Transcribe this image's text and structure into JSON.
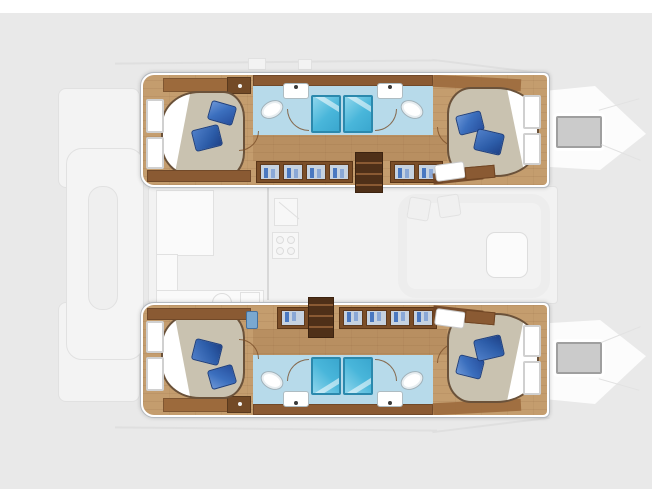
{
  "diagram": {
    "title": "catamaran-interior-layout-plan",
    "type": "yacht-deck-plan",
    "orientation": {
      "bow": "right",
      "stern": "left"
    },
    "palette": {
      "background": "#e9e9e9",
      "top_strip": "#ffffff",
      "hull_wall": "#ffffff",
      "wood_floor": "#c49d6e",
      "cabinet_brown": "#7b4e28",
      "stairs_brown": "#4f3018",
      "bed_mattress": "#c9c2b0",
      "pillow_blue": "#3b6fbe",
      "bathroom_floor": "#b7daea",
      "shower_blue": "#49b6da",
      "fixture_white": "#ffffff",
      "ghost_deck": "#f3f3f3",
      "bow_window_gray": "#cbcbcb"
    },
    "hulls": [
      {
        "id": "port-hull",
        "position": "top",
        "aft_cabin": {
          "label": "aft double cabin",
          "features": [
            "island-bed",
            "two-blue-pillows",
            "hull-windows",
            "dresser"
          ]
        },
        "aft_bathroom": {
          "label": "aft bathroom",
          "fixtures": [
            "shower",
            "toilet",
            "sink"
          ]
        },
        "fwd_bathroom": {
          "label": "forward bathroom",
          "fixtures": [
            "shower",
            "toilet",
            "sink"
          ]
        },
        "forward_cabin": {
          "label": "forward double cabin",
          "features": [
            "island-bed",
            "two-blue-pillows",
            "headboard-windows"
          ]
        },
        "corridor": {
          "label": "companionway corridor",
          "features": [
            "hanging-lockers",
            "stairs-to-saloon"
          ]
        }
      },
      {
        "id": "starboard-hull",
        "position": "bottom",
        "aft_cabin": {
          "label": "aft double cabin",
          "features": [
            "island-bed",
            "two-blue-pillows",
            "hull-windows",
            "dresser"
          ]
        },
        "aft_bathroom": {
          "label": "aft bathroom",
          "fixtures": [
            "shower",
            "toilet",
            "sink"
          ]
        },
        "fwd_bathroom": {
          "label": "forward bathroom",
          "fixtures": [
            "shower",
            "toilet",
            "sink"
          ]
        },
        "forward_cabin": {
          "label": "forward double cabin",
          "features": [
            "island-bed",
            "two-blue-pillows",
            "headboard-windows"
          ]
        },
        "corridor": {
          "label": "companionway corridor",
          "features": [
            "hanging-lockers",
            "stairs-to-saloon"
          ]
        }
      }
    ],
    "central_areas": [
      {
        "id": "saloon",
        "label": "saloon (ghosted)",
        "features": [
          "u-shaped-sofa",
          "table"
        ]
      },
      {
        "id": "galley",
        "label": "galley (ghosted)",
        "features": [
          "counter",
          "sink",
          "stove",
          "fridge"
        ]
      },
      {
        "id": "aft-cockpit",
        "label": "aft cockpit (ghosted)",
        "features": [
          "bench",
          "table"
        ]
      },
      {
        "id": "bow-decks",
        "label": "bow decks",
        "features": [
          "deck-hatch-window"
        ]
      }
    ]
  }
}
